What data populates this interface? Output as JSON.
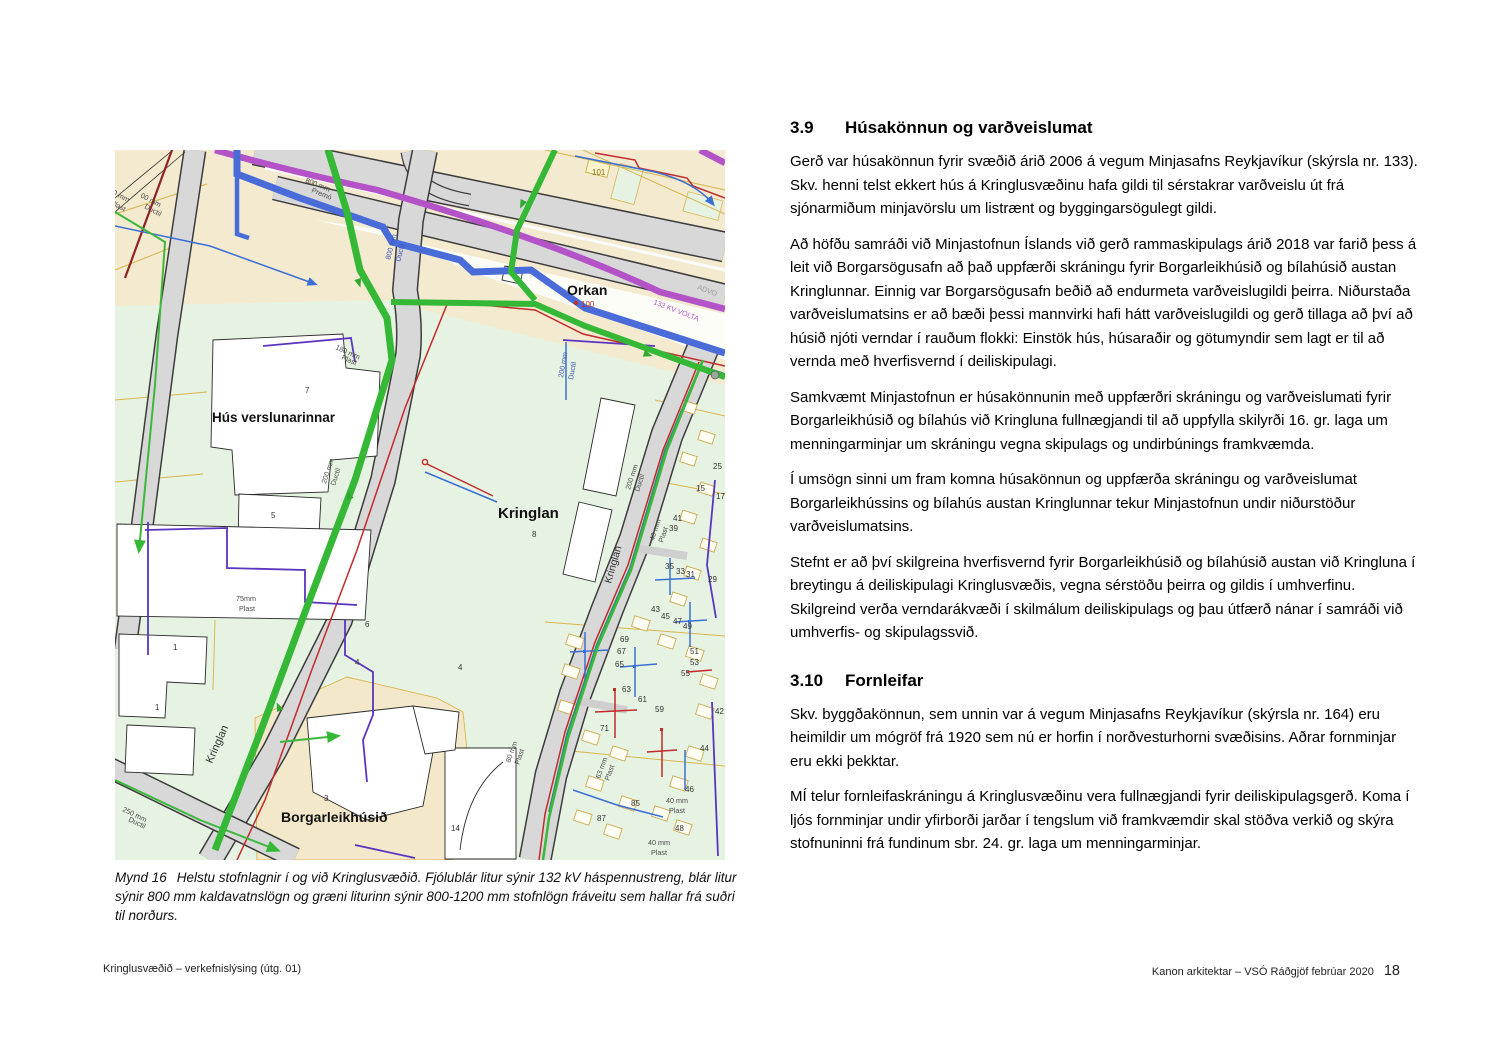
{
  "figure": {
    "caption_label": "Mynd 16",
    "caption_text": "Helstu stofnlagnir í og við Kringlusvæðið. Fjólublár litur sýnir 132 kV háspennustreng, blár litur sýnir 800 mm kaldavatnslögn og græni liturinn sýnir 800-1200 mm stofnlögn fráveitu sem hallar frá suðri til norðurs."
  },
  "map": {
    "legend_colors": {
      "high_voltage_132kv": "#b452c8",
      "cold_water_800mm": "#4a6cd9",
      "sewer_800_1200mm": "#35b835",
      "parcel_green": "#e7f3e2",
      "parcel_beige": "#f4e8ca",
      "road_gray": "#d8d8d8"
    },
    "place_labels": [
      {
        "t": "Orkan",
        "x": 452,
        "y": 145,
        "s": 14,
        "w": 1
      },
      {
        "t": "Hús verslunarinnar",
        "x": 97,
        "y": 272,
        "s": 13.5,
        "w": 1
      },
      {
        "t": "Kringlan",
        "x": 383,
        "y": 368,
        "s": 15,
        "w": 1
      },
      {
        "t": "Borgarleikhúsið",
        "x": 166,
        "y": 672,
        "s": 14,
        "w": 1
      }
    ],
    "street_labels": [
      {
        "t": "Kringlan",
        "x": 97,
        "y": 614,
        "r": -66,
        "s": 11
      },
      {
        "t": "Kringlan",
        "x": 496,
        "y": 434,
        "r": -74,
        "s": 10.5
      }
    ],
    "pipe_labels": [
      {
        "t": "800 mm",
        "x": 190,
        "y": 32,
        "r": 22
      },
      {
        "t": "Premó",
        "x": 196,
        "y": 42,
        "r": 22
      },
      {
        "t": "0 mm",
        "x": -3,
        "y": 44,
        "r": 28
      },
      {
        "t": "Plast",
        "x": -5,
        "y": 54,
        "r": 28
      },
      {
        "t": "00 mm",
        "x": 25,
        "y": 47,
        "r": 28
      },
      {
        "t": "Ductil",
        "x": 29,
        "y": 58,
        "r": 28
      },
      {
        "t": "180 mm",
        "x": 220,
        "y": 199,
        "r": 24
      },
      {
        "t": "Plast",
        "x": 226,
        "y": 209,
        "r": 24
      },
      {
        "t": "800 mm",
        "x": 275,
        "y": 110,
        "r": -75,
        "c": "#3a55b0"
      },
      {
        "t": "Ductil",
        "x": 285,
        "y": 112,
        "r": -75,
        "c": "#3a55b0"
      },
      {
        "t": "200 mm",
        "x": 211,
        "y": 334,
        "r": -72
      },
      {
        "t": "Ductil",
        "x": 220,
        "y": 336,
        "r": -72
      },
      {
        "t": "200 mm",
        "x": 448,
        "y": 228,
        "r": -80,
        "c": "#3a55b0"
      },
      {
        "t": "Ductil",
        "x": 458,
        "y": 230,
        "r": -80,
        "c": "#3a55b0"
      },
      {
        "t": "200 mm",
        "x": 515,
        "y": 340,
        "r": -72
      },
      {
        "t": "Ductil",
        "x": 524,
        "y": 342,
        "r": -72
      },
      {
        "t": "75mm",
        "x": 121,
        "y": 451
      },
      {
        "t": "Plast",
        "x": 124,
        "y": 461
      },
      {
        "t": "250 mm",
        "x": 7,
        "y": 661,
        "r": 26
      },
      {
        "t": "Ductil",
        "x": 13,
        "y": 671,
        "r": 26
      },
      {
        "t": "40 mm",
        "x": 539,
        "y": 391,
        "r": -72
      },
      {
        "t": "Plast",
        "x": 548,
        "y": 393,
        "r": -72
      },
      {
        "t": "63 mm",
        "x": 485,
        "y": 629,
        "r": -70
      },
      {
        "t": "Plast",
        "x": 494,
        "y": 631,
        "r": -70
      },
      {
        "t": "80 mm",
        "x": 395,
        "y": 613,
        "r": -70
      },
      {
        "t": "Plast",
        "x": 404,
        "y": 615,
        "r": -70
      },
      {
        "t": "40 mm",
        "x": 551,
        "y": 653
      },
      {
        "t": "Plast",
        "x": 554,
        "y": 663
      },
      {
        "t": "40 mm",
        "x": 533,
        "y": 695
      },
      {
        "t": "Plast",
        "x": 536,
        "y": 705
      },
      {
        "t": "132 KV VOLTA",
        "x": 538,
        "y": 154,
        "r": 21,
        "c": "#b452c8"
      },
      {
        "t": "ADVO",
        "x": 582,
        "y": 139,
        "r": 21,
        "c": "#9a9a9a"
      }
    ],
    "parcel_numbers": [
      {
        "t": "101",
        "x": 477,
        "y": 25,
        "c": "#8a6b1e"
      },
      {
        "t": "100",
        "x": 466,
        "y": 157,
        "c": "#c03028"
      },
      {
        "t": "7",
        "x": 190,
        "y": 243
      },
      {
        "t": "5",
        "x": 156,
        "y": 368
      },
      {
        "t": "8",
        "x": 417,
        "y": 387
      },
      {
        "t": "3",
        "x": 209,
        "y": 651
      },
      {
        "t": "14",
        "x": 336,
        "y": 681
      },
      {
        "t": "1",
        "x": 58,
        "y": 500
      },
      {
        "t": "1",
        "x": 40,
        "y": 560
      },
      {
        "t": "4",
        "x": 240,
        "y": 515
      },
      {
        "t": "4",
        "x": 343,
        "y": 520
      },
      {
        "t": "6",
        "x": 250,
        "y": 477
      },
      {
        "t": "69",
        "x": 505,
        "y": 492
      },
      {
        "t": "67",
        "x": 502,
        "y": 504
      },
      {
        "t": "65",
        "x": 500,
        "y": 517
      },
      {
        "t": "63",
        "x": 507,
        "y": 542
      },
      {
        "t": "61",
        "x": 523,
        "y": 552
      },
      {
        "t": "59",
        "x": 540,
        "y": 562
      },
      {
        "t": "49",
        "x": 568,
        "y": 479
      },
      {
        "t": "51",
        "x": 575,
        "y": 504
      },
      {
        "t": "53",
        "x": 575,
        "y": 515
      },
      {
        "t": "55",
        "x": 566,
        "y": 526
      },
      {
        "t": "71",
        "x": 485,
        "y": 581
      },
      {
        "t": "87",
        "x": 482,
        "y": 671
      },
      {
        "t": "85",
        "x": 516,
        "y": 656
      },
      {
        "t": "44",
        "x": 585,
        "y": 601
      },
      {
        "t": "46",
        "x": 570,
        "y": 642
      },
      {
        "t": "48",
        "x": 560,
        "y": 681
      },
      {
        "t": "42",
        "x": 600,
        "y": 564
      },
      {
        "t": "41",
        "x": 558,
        "y": 371
      },
      {
        "t": "39",
        "x": 554,
        "y": 381
      },
      {
        "t": "35",
        "x": 550,
        "y": 419
      },
      {
        "t": "33",
        "x": 561,
        "y": 424
      },
      {
        "t": "31",
        "x": 571,
        "y": 427
      },
      {
        "t": "29",
        "x": 593,
        "y": 432
      },
      {
        "t": "15",
        "x": 581,
        "y": 341
      },
      {
        "t": "17",
        "x": 601,
        "y": 349
      },
      {
        "t": "25",
        "x": 598,
        "y": 319
      },
      {
        "t": "43",
        "x": 536,
        "y": 462
      },
      {
        "t": "45",
        "x": 546,
        "y": 469
      },
      {
        "t": "47",
        "x": 558,
        "y": 474
      }
    ]
  },
  "sections": [
    {
      "number": "3.9",
      "title": "Húsakönnun og varðveislumat",
      "paragraphs": [
        "Gerð var húsakönnun fyrir svæðið árið 2006 á vegum Minjasafns Reykjavíkur (skýrsla nr. 133). Skv. henni telst ekkert hús á Kringlusvæðinu hafa gildi til sérstakrar varðveislu út frá sjónarmiðum minjavörslu um listrænt og byggingarsögulegt gildi.",
        "Að höfðu samráði við Minjastofnun Íslands við gerð rammaskipulags árið 2018 var farið þess á leit við Borgarsögusafn að það uppfærði skráningu fyrir Borgarleikhúsið og bílahúsið austan Kringlunnar. Einnig var Borgarsögusafn beðið að endurmeta varð­veislugildi þeirra. Niðurstaða varðveislumatsins er að bæði þessi mannvirki hafi hátt varðveislugildi og gerð tillaga að því að húsið njóti verndar í rauðum flokki: Einstök hús, húsaraðir og götumyndir sem lagt er til að vernda með hverfisvernd í deiliskipulagi.",
        "Samkvæmt Minjastofnun er húsakönnunin með uppfærðri skráningu og varðveislumati fyrir Borgarleikhúsið og bílahús við Kringluna fullnægjandi til að uppfylla skilyrði 16. gr. laga um menningarminjar um skráningu vegna skipulags og undirbúnings framkvæmda.",
        "Í umsögn sinni um fram komna húsakönnun og uppfærða skráningu og varðveislumat Borgarleikhússins og bílahús austan Kringlunnar tekur Minjastofnun undir niðurstöður varðveislumatsins.",
        "Stefnt er að því skilgreina hverfisvernd fyrir Borgarleikhúsið og bílahúsið austan við Kringluna í breytingu á deiliskipulagi Kringlusvæðis, vegna sérstöðu þeirra og gildis í umhverfinu. Skilgreind verða verndarákvæði í skilmálum deiliskipulags og þau útfærð nánar í samráði við umhverfis- og skipulagssvið."
      ]
    },
    {
      "number": "3.10",
      "title": "Fornleifar",
      "paragraphs": [
        "Skv. byggðakönnun, sem unnin var á vegum Minjasafns Reykjavíkur (skýrsla nr. 164) eru heimildir um mógröf frá 1920 sem nú er horfin í norðvesturhorni svæðisins. Aðrar fornminjar eru ekki þekktar.",
        "MÍ telur fornleifaskráningu á Kringlusvæðinu vera fullnægjandi fyrir deiliskipulagsgerð. Koma í ljós fornminjar undir yfirborði jarðar í tengslum við framkvæmdir skal stöðva verkið og skýra stofnuninni frá fundinum sbr. 24. gr. laga um menningarminjar."
      ]
    }
  ],
  "footer": {
    "left": "Kringlusvæðið – verkefnislýsing (útg. 01)",
    "right": "Kanon arkitektar – VSÓ Ráðgjöf febrúar 2020",
    "page_number": "18"
  }
}
